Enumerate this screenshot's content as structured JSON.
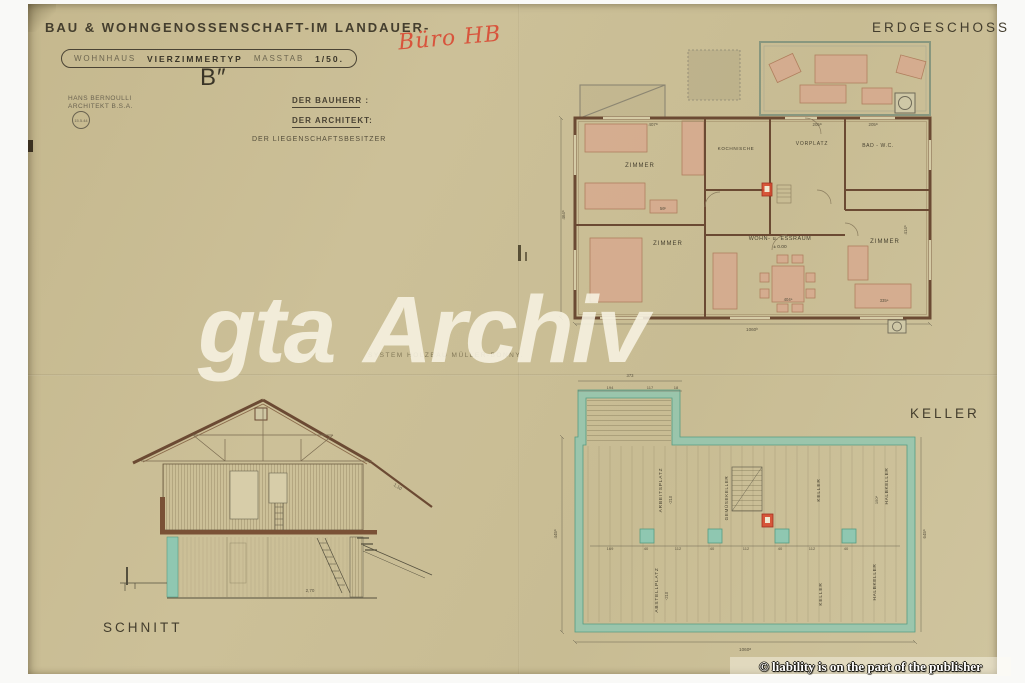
{
  "colors": {
    "paper": "#c9bd95",
    "ink": "#3e392b",
    "wall_brown": "#6b4a33",
    "furniture_pink": "#d8a78e",
    "wall_teal": "#8fc7b1",
    "accent_red": "#d84a30",
    "handwriting_red": "#d8543c",
    "watermark_cream": "#f7f3e3"
  },
  "header": {
    "title": "BAU & WOHNGENOSSENSCHAFT-IM LANDAUER-",
    "box_label_1": "WOHNHAUS",
    "box_label_2": "VIERZIMMERTYP",
    "box_label_3": "MASSTAB",
    "box_label_4": "1/50.",
    "variant": "B″",
    "architect_line_1": "HANS BERNOULLI",
    "architect_line_2": "ARCHITEKT B.S.A.",
    "stamp_text": "15.5.44",
    "sig_bauherr": "DER BAUHERR :",
    "sig_architekt": "DER ARCHITEKT:",
    "sig_besitzer": "DER LIEGENSCHAFTSBESITZER",
    "handwriting": "Büro HB"
  },
  "notes": {
    "system_note": "SYSTEM HOLZBAU MÜLLER-BONNY.",
    "watermark": "gta Archiv",
    "publisher": "© liability is on the part of the publisher"
  },
  "erdgeschoss": {
    "title": "ERDGESCHOSS",
    "room_zimmer_nw": "ZIMMER",
    "room_kochnische": "KOCHNISCHE",
    "room_vorplatz": "VORPLATZ",
    "room_bad": "BAD - W.C.",
    "room_zimmer_sw": "ZIMMER",
    "room_wohn": "WOHN- u. ESSRAUM",
    "level": "± 0.00",
    "room_zimmer_se": "ZIMMER",
    "dim_top_1": "407ᵃ",
    "dim_top_2": "205ᵃ",
    "dim_top_3": "205ᵃ",
    "dim_left": "464ᵃ",
    "dim_right": "414ᵃ",
    "dim_bottom": "1060ᵇ",
    "dim_table": "404ᵃ",
    "dim_bed": "335ᵃ",
    "dim_small": "56ᵇ"
  },
  "keller": {
    "title": "KELLER",
    "room_arbeitsplatz": "ARBEITSPLATZ",
    "room_gemuese": "GEMÜSEKELLER",
    "room_keller_n": "KELLER",
    "room_halbkeller_n": "HALBKELLER",
    "room_abstellplatz": "ABSTELLPLATZ",
    "room_keller_s": "KELLER",
    "room_halbkeller_s": "HALBKELLER",
    "depth_1": "-210",
    "depth_2": "-210",
    "dim_top_1": "373",
    "dim_top_2": "194",
    "dim_top_3": "117",
    "dim_top_4": "18",
    "dim_left": "445ᵃ",
    "dim_right": "645ᵃ",
    "dim_bottom": "1060ᵃ",
    "dim_150": "150ᵃ",
    "row": [
      "169",
      "40",
      "112",
      "40",
      "112",
      "40",
      "112",
      "40"
    ]
  },
  "schnitt": {
    "title": "SCHNITT",
    "dim_1": "1,10",
    "dim_2": "2,70"
  }
}
